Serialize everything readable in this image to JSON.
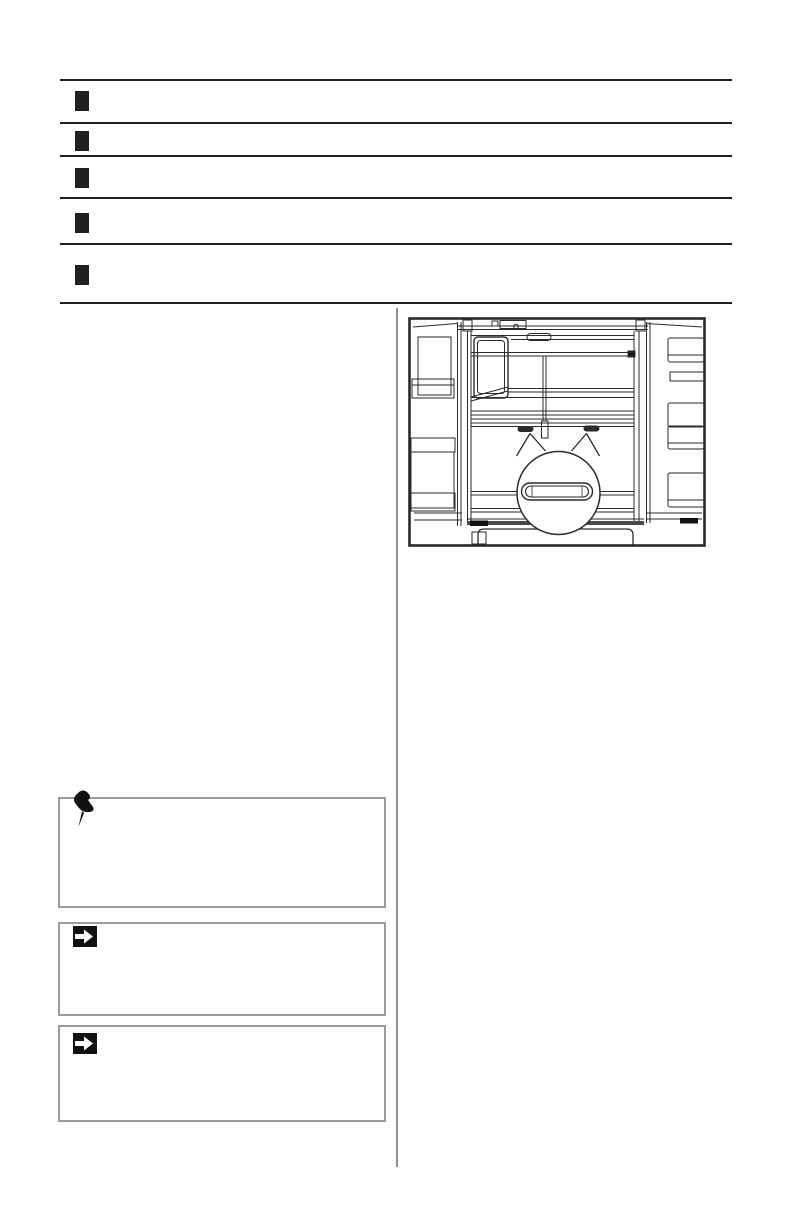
{
  "page": {
    "background": "#ffffff",
    "kind": "manual-page",
    "visible_text": ""
  },
  "toc_list": {
    "row_count": 5,
    "marker_glyph": "black-square",
    "marker_color": "#231f20",
    "rule_color": "#231f20",
    "rows": [
      {
        "marker": "black-square",
        "label": ""
      },
      {
        "marker": "black-square",
        "label": ""
      },
      {
        "marker": "black-square",
        "label": ""
      },
      {
        "marker": "black-square",
        "label": ""
      },
      {
        "marker": "black-square",
        "label": ""
      }
    ]
  },
  "layout": {
    "columns": 2,
    "divider_color": "#8f8f8f"
  },
  "figure": {
    "type": "line-art",
    "subject": "refrigerator interior, both doors open with door bins, shelves, lower drawer; circular magnifier callout with two pointer spikes highlighting two drawer slots and a recessed pull handle",
    "border_color": "#231f20",
    "line_color": "#2a2a2a",
    "slot_fill": "#2e2a2b"
  },
  "note_boxes": [
    {
      "icon": "pushpin-icon",
      "border_color": "#9c9c9c",
      "icon_color": "#111111",
      "text": ""
    },
    {
      "icon": "arrow-right-icon",
      "border_color": "#9c9c9c",
      "icon_bg": "#111111",
      "arrow_color": "#ffffff",
      "text": ""
    },
    {
      "icon": "arrow-right-icon",
      "border_color": "#9c9c9c",
      "icon_bg": "#111111",
      "arrow_color": "#ffffff",
      "text": ""
    }
  ]
}
